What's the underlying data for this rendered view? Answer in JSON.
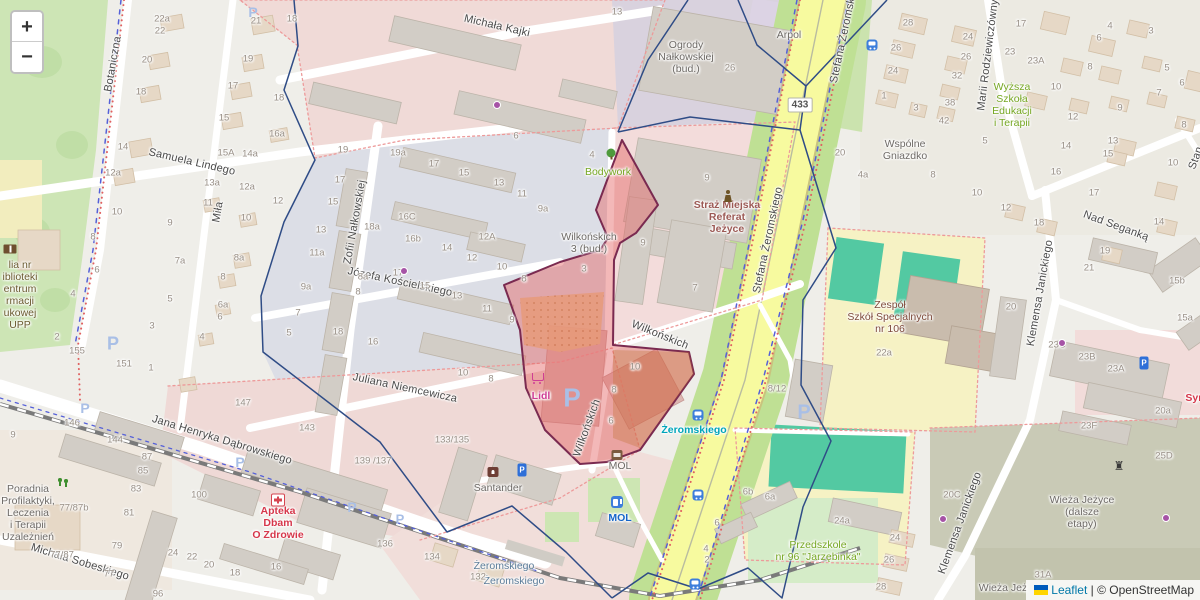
{
  "controls": {
    "zoom_in": "+",
    "zoom_out": "−"
  },
  "attribution": {
    "leaflet": "Leaflet",
    "separator": " | © ",
    "osm": "OpenStreetMap",
    "flag_top": "#005BBB",
    "flag_bottom": "#FFD500"
  },
  "road_badge": "433",
  "colors": {
    "selection_fill": "rgba(228,98,98,0.45)",
    "selection_stroke": "#7A2A50",
    "boundary_blue": "#2F4C86",
    "road_yellow": "#F7FA9F",
    "park_green": "#CDE5B5",
    "pitch_teal": "#53C9A2",
    "admin_red": "#E06060",
    "admin_blue": "#5560D8"
  },
  "streets": [
    [
      "Michała Kajki",
      497,
      26,
      13
    ],
    [
      "Samuela Lindego",
      192,
      162,
      13
    ],
    [
      "Zofii Nałkowskiej",
      355,
      222,
      -80
    ],
    [
      "Józefa Kościelskiego",
      400,
      282,
      12
    ],
    [
      "Juliana Niemcewicza",
      405,
      388,
      12
    ],
    [
      "Jana Henryka Dąbrowskiego",
      222,
      440,
      17
    ],
    [
      "Michała Sobeskiego",
      80,
      562,
      17
    ],
    [
      "Botaniczna",
      113,
      64,
      -80
    ],
    [
      "Miła",
      218,
      212,
      -80
    ],
    [
      "Wilkońskich",
      660,
      335,
      22
    ],
    [
      "Wilkońskich",
      587,
      428,
      -70
    ],
    [
      "Stefana Żeromskiego",
      768,
      240,
      -78
    ],
    [
      "Stefana Żeromskiego",
      845,
      30,
      -78
    ],
    [
      "Marii Rodziewiczówny",
      988,
      55,
      -83
    ],
    [
      "Nad Seganką",
      1116,
      226,
      20
    ],
    [
      "Klemensa Janickiego",
      1040,
      293,
      -80
    ],
    [
      "Klemensa Janickiego",
      960,
      523,
      -70
    ],
    [
      "Stan",
      1196,
      158,
      -70
    ]
  ],
  "pois": [
    [
      "Ogrody\nNałkowskiej\n(bud.)",
      686,
      57,
      "c-gray"
    ],
    [
      "Arpol",
      789,
      35,
      "c-gray"
    ],
    [
      "Bodywork",
      608,
      172,
      "c-green"
    ],
    [
      "Wilkońskich\n3 (bud.)",
      589,
      243,
      "c-gray"
    ],
    [
      "Straż Miejska\nReferat\nJeżyce",
      727,
      217,
      "c-darkred"
    ],
    [
      "Wspólne\nGniazdko",
      905,
      150,
      "c-gray"
    ],
    [
      "Wyższa\nSzkoła\nEdukacji\ni Terapii",
      1012,
      105,
      "c-green"
    ],
    [
      "Zespół\nSzkół Specjalnych\nnr 106",
      890,
      317,
      "c-brown"
    ],
    [
      "Lidl",
      541,
      396,
      "c-magenta"
    ],
    [
      "Santander",
      498,
      488,
      "c-gray"
    ],
    [
      "MOL",
      620,
      466,
      "c-gray"
    ],
    [
      "MOL",
      620,
      518,
      "c-blue"
    ],
    [
      "Żeromskiego",
      694,
      430,
      "c-teal"
    ],
    [
      "Apteka\nDbam\nO Zdrowie",
      278,
      523,
      "c-red"
    ],
    [
      "Poradnia\nProfilaktyki,\nLeczenia\ni Terapii\nUzależnień",
      28,
      513,
      "c-gray"
    ],
    [
      "Przedszkole\nnr 96 \"Jarzębinka\"",
      818,
      551,
      "c-green"
    ],
    [
      "Wieża Jeżyce\n(dalsze\netapy)",
      1082,
      512,
      "c-gray"
    ],
    [
      "Wieża Jeż",
      1003,
      588,
      "c-gray"
    ],
    [
      "lia nr\niblioteki\nentrum\nrmacji\nukowej\nUPP",
      20,
      295,
      "c-olive"
    ],
    [
      "Żeromskiego",
      504,
      566,
      "c-slate"
    ],
    [
      "Żeromskiego",
      514,
      581,
      "c-slate"
    ],
    [
      "Syn",
      1195,
      398,
      "c-red"
    ]
  ],
  "numbers": [
    [
      "22a",
      162,
      19
    ],
    [
      "22",
      160,
      31
    ],
    [
      "20",
      147,
      60
    ],
    [
      "18",
      141,
      92
    ],
    [
      "14",
      123,
      147
    ],
    [
      "12a",
      113,
      173
    ],
    [
      "21",
      256,
      21
    ],
    [
      "19",
      248,
      59
    ],
    [
      "17",
      233,
      86
    ],
    [
      "15",
      224,
      118
    ],
    [
      "16a",
      277,
      134
    ],
    [
      "15A",
      226,
      153
    ],
    [
      "14a",
      250,
      154
    ],
    [
      "18",
      292,
      19
    ],
    [
      "18",
      279,
      98
    ],
    [
      "13a",
      212,
      183
    ],
    [
      "12a",
      247,
      187
    ],
    [
      "12",
      278,
      201
    ],
    [
      "11",
      208,
      203
    ],
    [
      "10",
      246,
      218
    ],
    [
      "8a",
      239,
      258
    ],
    [
      "8",
      223,
      277
    ],
    [
      "6a",
      223,
      305
    ],
    [
      "6",
      220,
      317
    ],
    [
      "4",
      202,
      337
    ],
    [
      "19",
      343,
      150
    ],
    [
      "17",
      340,
      180
    ],
    [
      "15",
      333,
      202
    ],
    [
      "13",
      321,
      230
    ],
    [
      "11a",
      317,
      253
    ],
    [
      "9a",
      306,
      287
    ],
    [
      "7",
      298,
      313
    ],
    [
      "5",
      289,
      333
    ],
    [
      "19a",
      398,
      153
    ],
    [
      "17",
      434,
      164
    ],
    [
      "15",
      464,
      173
    ],
    [
      "13",
      499,
      183
    ],
    [
      "16C",
      407,
      217
    ],
    [
      "18a",
      372,
      227
    ],
    [
      "16b",
      413,
      239
    ],
    [
      "14",
      447,
      248
    ],
    [
      "12A",
      487,
      237
    ],
    [
      "12",
      472,
      258
    ],
    [
      "10",
      502,
      267
    ],
    [
      "17",
      398,
      273
    ],
    [
      "15",
      425,
      286
    ],
    [
      "13",
      457,
      296
    ],
    [
      "11",
      487,
      309
    ],
    [
      "8a",
      363,
      277
    ],
    [
      "8",
      358,
      292
    ],
    [
      "18",
      338,
      332
    ],
    [
      "16",
      373,
      342
    ],
    [
      "9",
      512,
      320
    ],
    [
      "10",
      117,
      212
    ],
    [
      "9",
      170,
      223
    ],
    [
      "8",
      93,
      237
    ],
    [
      "6",
      97,
      270
    ],
    [
      "7a",
      180,
      261
    ],
    [
      "5",
      170,
      299
    ],
    [
      "4",
      73,
      294
    ],
    [
      "3",
      152,
      326
    ],
    [
      "2",
      57,
      337
    ],
    [
      "155",
      77,
      351
    ],
    [
      "151",
      124,
      364
    ],
    [
      "1",
      151,
      368
    ],
    [
      "9",
      13,
      435
    ],
    [
      "11",
      522,
      194
    ],
    [
      "9a",
      543,
      209
    ],
    [
      "8",
      524,
      279
    ],
    [
      "3",
      584,
      269
    ],
    [
      "9",
      643,
      243
    ],
    [
      "7",
      695,
      288
    ],
    [
      "10",
      635,
      367
    ],
    [
      "8",
      614,
      390
    ],
    [
      "6",
      611,
      421
    ],
    [
      "10",
      463,
      373
    ],
    [
      "8",
      491,
      379
    ],
    [
      "13",
      617,
      12
    ],
    [
      "6",
      516,
      136
    ],
    [
      "4",
      592,
      155
    ],
    [
      "9",
      707,
      178
    ],
    [
      "26",
      730,
      68
    ],
    [
      "28",
      908,
      23
    ],
    [
      "26",
      896,
      48
    ],
    [
      "24",
      893,
      71
    ],
    [
      "1",
      884,
      96
    ],
    [
      "3",
      916,
      108
    ],
    [
      "20",
      840,
      153
    ],
    [
      "4a",
      863,
      175
    ],
    [
      "8",
      933,
      175
    ],
    [
      "10",
      977,
      193
    ],
    [
      "5",
      985,
      141
    ],
    [
      "26",
      966,
      57
    ],
    [
      "32",
      957,
      76
    ],
    [
      "38",
      950,
      103
    ],
    [
      "42",
      944,
      121
    ],
    [
      "24",
      968,
      37
    ],
    [
      "17",
      1021,
      24
    ],
    [
      "23",
      1010,
      52
    ],
    [
      "23A",
      1036,
      61
    ],
    [
      "10",
      1056,
      87
    ],
    [
      "12",
      1073,
      117
    ],
    [
      "14",
      1066,
      146
    ],
    [
      "16",
      1056,
      172
    ],
    [
      "4",
      1110,
      26
    ],
    [
      "6",
      1099,
      38
    ],
    [
      "8",
      1090,
      67
    ],
    [
      "3",
      1151,
      31
    ],
    [
      "5",
      1167,
      68
    ],
    [
      "6",
      1182,
      83
    ],
    [
      "7",
      1159,
      93
    ],
    [
      "9",
      1120,
      108
    ],
    [
      "8",
      1184,
      125
    ],
    [
      "13",
      1113,
      141
    ],
    [
      "15",
      1108,
      154
    ],
    [
      "10",
      1173,
      163
    ],
    [
      "17",
      1094,
      193
    ],
    [
      "12",
      1006,
      208
    ],
    [
      "18",
      1039,
      223
    ],
    [
      "19",
      1105,
      251
    ],
    [
      "21",
      1089,
      268
    ],
    [
      "20",
      1011,
      307
    ],
    [
      "23C",
      1057,
      345
    ],
    [
      "23B",
      1087,
      357
    ],
    [
      "23A",
      1116,
      369
    ],
    [
      "15b",
      1177,
      281
    ],
    [
      "15a",
      1185,
      318
    ],
    [
      "14",
      1159,
      222
    ],
    [
      "22a",
      884,
      353
    ],
    [
      "20a",
      1163,
      411
    ],
    [
      "23F",
      1089,
      426
    ],
    [
      "25D",
      1164,
      456
    ],
    [
      "20C",
      952,
      495
    ],
    [
      "31A",
      1043,
      575
    ],
    [
      "134",
      432,
      557
    ],
    [
      "132",
      478,
      577
    ],
    [
      "6b",
      748,
      492
    ],
    [
      "6a",
      770,
      497
    ],
    [
      "6",
      717,
      523
    ],
    [
      "24a",
      842,
      521
    ],
    [
      "24",
      895,
      538
    ],
    [
      "26",
      889,
      560
    ],
    [
      "28",
      881,
      587
    ],
    [
      "4",
      706,
      549
    ],
    [
      "2",
      707,
      560
    ],
    [
      "146",
      72,
      423
    ],
    [
      "144",
      115,
      440
    ],
    [
      "87",
      147,
      457
    ],
    [
      "85",
      143,
      471
    ],
    [
      "83",
      136,
      489
    ],
    [
      "81",
      129,
      513
    ],
    [
      "79",
      117,
      546
    ],
    [
      "77",
      109,
      574
    ],
    [
      "100",
      199,
      495
    ],
    [
      "24",
      173,
      553
    ],
    [
      "22",
      192,
      557
    ],
    [
      "20",
      209,
      565
    ],
    [
      "18",
      235,
      573
    ],
    [
      "16",
      276,
      567
    ],
    [
      "147",
      243,
      403
    ],
    [
      "143",
      307,
      428
    ],
    [
      "136",
      385,
      544
    ],
    [
      "96",
      158,
      594
    ],
    [
      "77/87b",
      74,
      508
    ],
    [
      "77/87",
      62,
      555
    ],
    [
      "133/135",
      452,
      440
    ],
    [
      "139 /137",
      373,
      461
    ],
    [
      "8/12",
      777,
      389
    ]
  ],
  "parking_lots": [
    [
      572,
      398,
      26
    ],
    [
      804,
      413,
      20
    ],
    [
      113,
      344,
      18
    ],
    [
      253,
      12,
      14
    ],
    [
      240,
      462,
      14
    ],
    [
      85,
      408,
      14
    ],
    [
      352,
      507,
      14
    ],
    [
      400,
      519,
      13
    ]
  ],
  "icons": [
    [
      "bus",
      698,
      415
    ],
    [
      "bus",
      698,
      495
    ],
    [
      "bus",
      872,
      45
    ],
    [
      "bus",
      695,
      584
    ],
    [
      "fuel",
      617,
      502
    ],
    [
      "shop",
      617,
      455
    ],
    [
      "pharmacy",
      278,
      500
    ],
    [
      "guard",
      728,
      196
    ],
    [
      "book",
      10,
      249
    ],
    [
      "bank",
      493,
      472
    ],
    [
      "cart",
      538,
      377
    ],
    [
      "tree",
      611,
      153
    ],
    [
      "playground",
      63,
      482
    ],
    [
      "tower",
      1119,
      466
    ],
    [
      "meter",
      522,
      470
    ],
    [
      "meter",
      1144,
      363
    ],
    [
      "dot",
      404,
      271
    ],
    [
      "dot",
      497,
      105
    ],
    [
      "dot",
      1062,
      343
    ],
    [
      "dot",
      1166,
      518
    ],
    [
      "dot",
      943,
      519
    ]
  ]
}
